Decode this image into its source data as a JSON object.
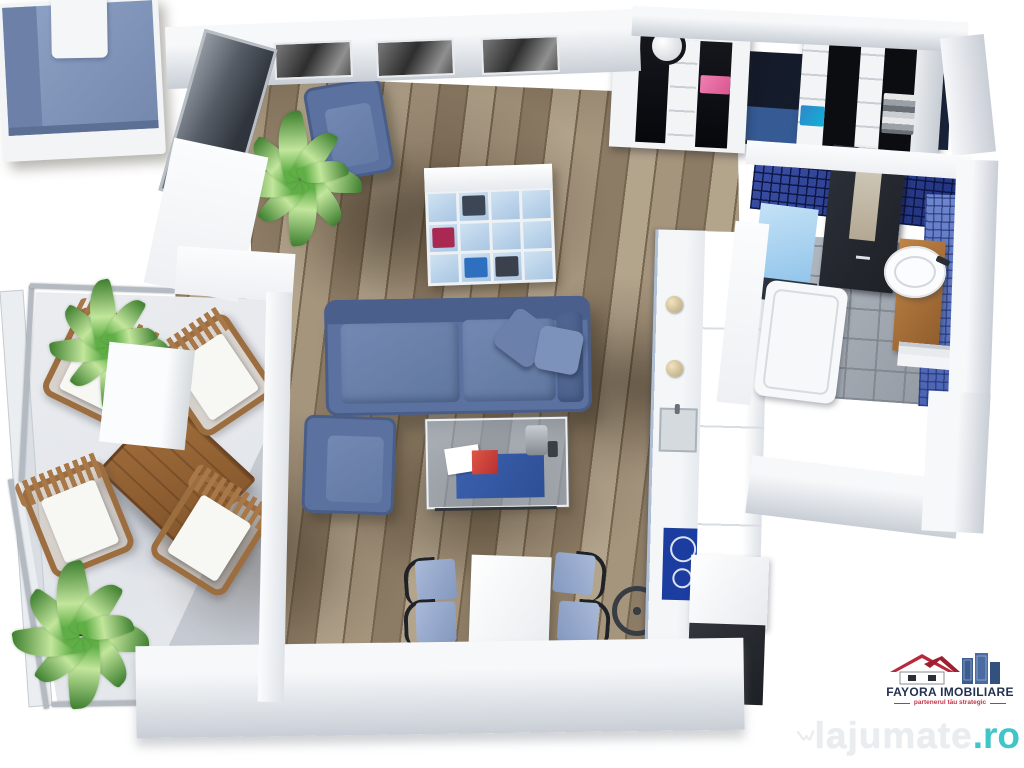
{
  "scene": {
    "type": "3d-floor-plan-render",
    "description": "Top-down 3D rendering of a one-bedroom apartment with open living area",
    "rooms": [
      "bedroom",
      "living-room",
      "dining-area",
      "kitchen",
      "dressing-area",
      "bathroom",
      "balcony"
    ],
    "furniture": {
      "bedroom": [
        "double-bed-blue",
        "cube-shelf-unit",
        "blue-armchair",
        "potted-plant",
        "three-wall-photos"
      ],
      "living_room": [
        "blue-corner-sofa",
        "two-pillows",
        "blue-armchair",
        "glass-coffee-table",
        "magazines"
      ],
      "dining_area": [
        "white-table",
        "four-blue-chairs",
        "serving-cart-wheel"
      ],
      "kitchen": [
        "counter-run",
        "sink",
        "blue-induction-cooktop",
        "tall-cabinets",
        "dark-appliance",
        "two-bowls"
      ],
      "dressing_area": [
        "two-wardrobe-units",
        "wall-clock",
        "folded-clothes-pink",
        "folded-clothes-blue",
        "folded-clothes-gray"
      ],
      "bathroom": [
        "walk-in-shower",
        "bathtub",
        "round-sink-on-wood-vanity",
        "blue-mosaic-walls",
        "towel-rail"
      ],
      "balcony": [
        "wooden-table",
        "four-wooden-chairs-white-cushions",
        "two-potted-plants",
        "glass-railing"
      ]
    }
  },
  "palette": {
    "wall_top": "#f7f8fa",
    "wall_face": "#c9ced6",
    "wood_a": "#a6957d",
    "wood_b": "#8d7c65",
    "wood_c": "#77664f",
    "balcony_floor": "#e2e5ea",
    "floor_dark": "#11141c",
    "sofa": "#5b72a0",
    "sofa_dark": "#4a5f8c",
    "cushion": "#7389b3",
    "bed_blanket": "#8fa3c6",
    "bed_fold": "#6d81a8",
    "kallax_cell": "#a9c6e2",
    "kallax_i1": "#3c4654",
    "kallax_i2": "#a92952",
    "kallax_i3": "#2f6fc0",
    "kallax_i4": "#3a414d",
    "tile_dark": "#1e2f7a",
    "tile_light": "#6d86cd",
    "shower_dark": "#1e2127",
    "tray_blue": "#8fc3ea",
    "vanity": "#8e5c2c",
    "cooktop": "#1c3da0",
    "appliance": "#1d2025",
    "clock": "#15161a",
    "wood_furn": "#a4703d",
    "chair_seat": "#a9b9d8",
    "chair_frame": "#1f2327",
    "plant": "#5fae46",
    "plant_dark": "#3c7d2e",
    "agency_text": "#233150",
    "agency_tag": "#c2344a",
    "agency_roof": "#b8293c",
    "agency_building": "#3b5d92",
    "wm_text": "#e9edf0",
    "wm_tld": "#3fc6c8"
  },
  "branding": {
    "agency": {
      "name": "FAYORA IMOBILIARE",
      "tagline": "partenerul tău strategic"
    },
    "watermark": {
      "brand": "lajumate",
      "tld": ".ro"
    }
  }
}
